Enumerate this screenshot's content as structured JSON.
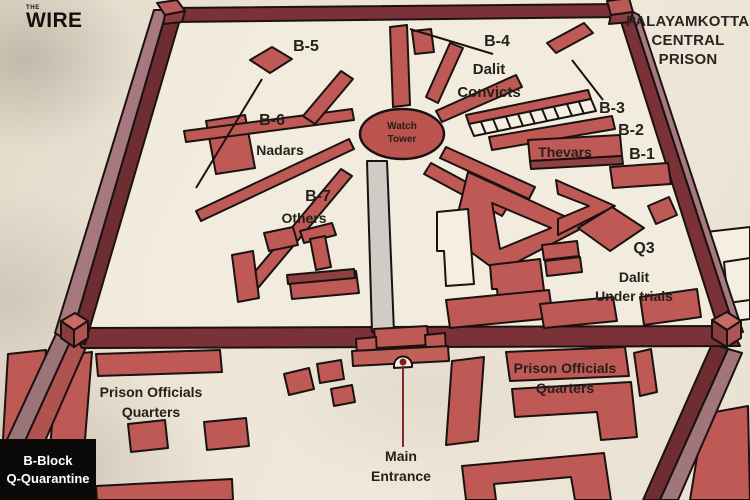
{
  "brand": {
    "the": "THE",
    "wire": "WIRE"
  },
  "title": "PALAYAMKOTTAI\nCENTRAL\nPRISON",
  "labels": {
    "b5": "B-5",
    "b4": "B-4",
    "dalit_convicts": "Dalit\nConvicts",
    "b3": "B-3",
    "b2": "B-2",
    "b1": "B-1",
    "thevars": "Thevars",
    "b6": "B-6",
    "nadars": "Nadars",
    "b7": "B-7",
    "others": "Others",
    "watch_tower": "Watch\nTower",
    "q3": "Q3",
    "dalit_under_trials": "Dalit\nUnder trials",
    "prison_officials_left": "Prison Officials\nQuarters",
    "prison_officials_right": "Prison Officials\nQuarters",
    "main_entrance": "Main\nEntrance",
    "legend": "B-Block\nQ-Quarantine"
  },
  "colors": {
    "building_red": "#bf5955",
    "building_dark": "#8e4140",
    "wall_dark": "#6e2d33",
    "wall_mid": "#7a3138",
    "wall_light": "#a5797d",
    "outline": "#1a1210",
    "interior_floor": "#f2ecdf",
    "path_gray": "#d1cbc5",
    "white_building": "#f5efe2",
    "entrance_line": "#8a2525",
    "legend_bg": "#0c0a09",
    "legend_text": "#ffffff",
    "label_text": "#24201c",
    "background": "#eae2d3"
  }
}
